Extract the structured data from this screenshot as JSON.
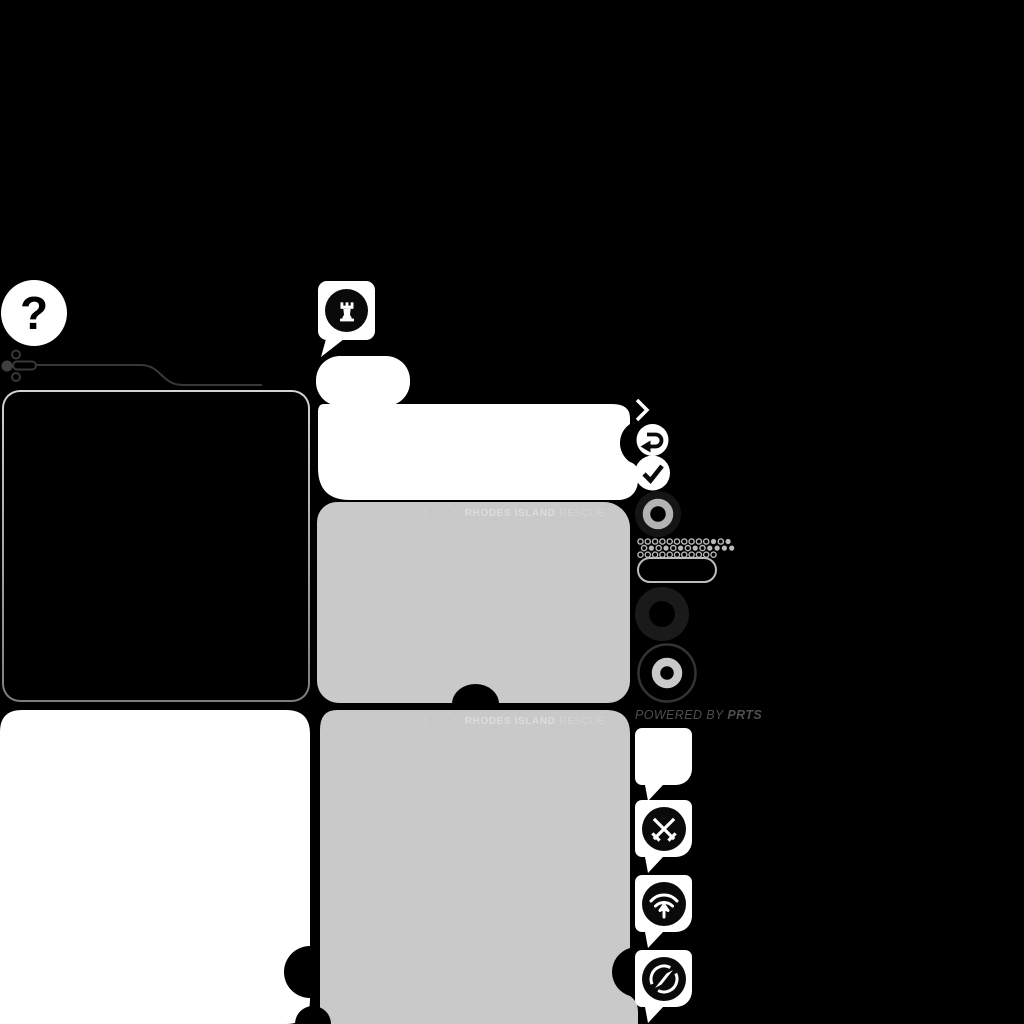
{
  "window": {
    "width": 1024,
    "height": 1024,
    "app": "game-main-menu"
  },
  "colors": {
    "background": "#000000",
    "panel_white": "#ffffff",
    "panel_gray": "#c9c9c9",
    "panel_border": "#bdbdbd",
    "banner_text_strong": "#dcdcdc",
    "banner_text_light": "#d4d4d4",
    "powered_text": "#4e4e4e",
    "decor_line": "#383838",
    "halftone_dot": "#b9b9b9",
    "donut_dark": "#1a1a1a",
    "donut_ring_gray": "#b3b3b3",
    "ring_outline": "#333333"
  },
  "help_button": {
    "label": "?"
  },
  "chat_top": {
    "icon": "chess-rook-icon"
  },
  "rescue_banner": {
    "dots": ": : : : : : : : : : : :",
    "title_strong": "RHODES ISLAND",
    "title_light": "RESCUE"
  },
  "footer": {
    "powered_prefix": "POWERED BY ",
    "brand": "PRTS"
  },
  "right_rail_icons": [
    "chevron-right",
    "undo-arrow",
    "checkmark",
    "donut-small",
    "halftone-dots",
    "pill-outline",
    "donut-large",
    "target-ring"
  ],
  "notification_bubbles": [
    "empty",
    "crossed-swords",
    "wifi-upload",
    "compass"
  ],
  "halftone": {
    "rows": [
      "oooooooooofof",
      "ofofofofoffff",
      "ooooooooooo"
    ]
  }
}
